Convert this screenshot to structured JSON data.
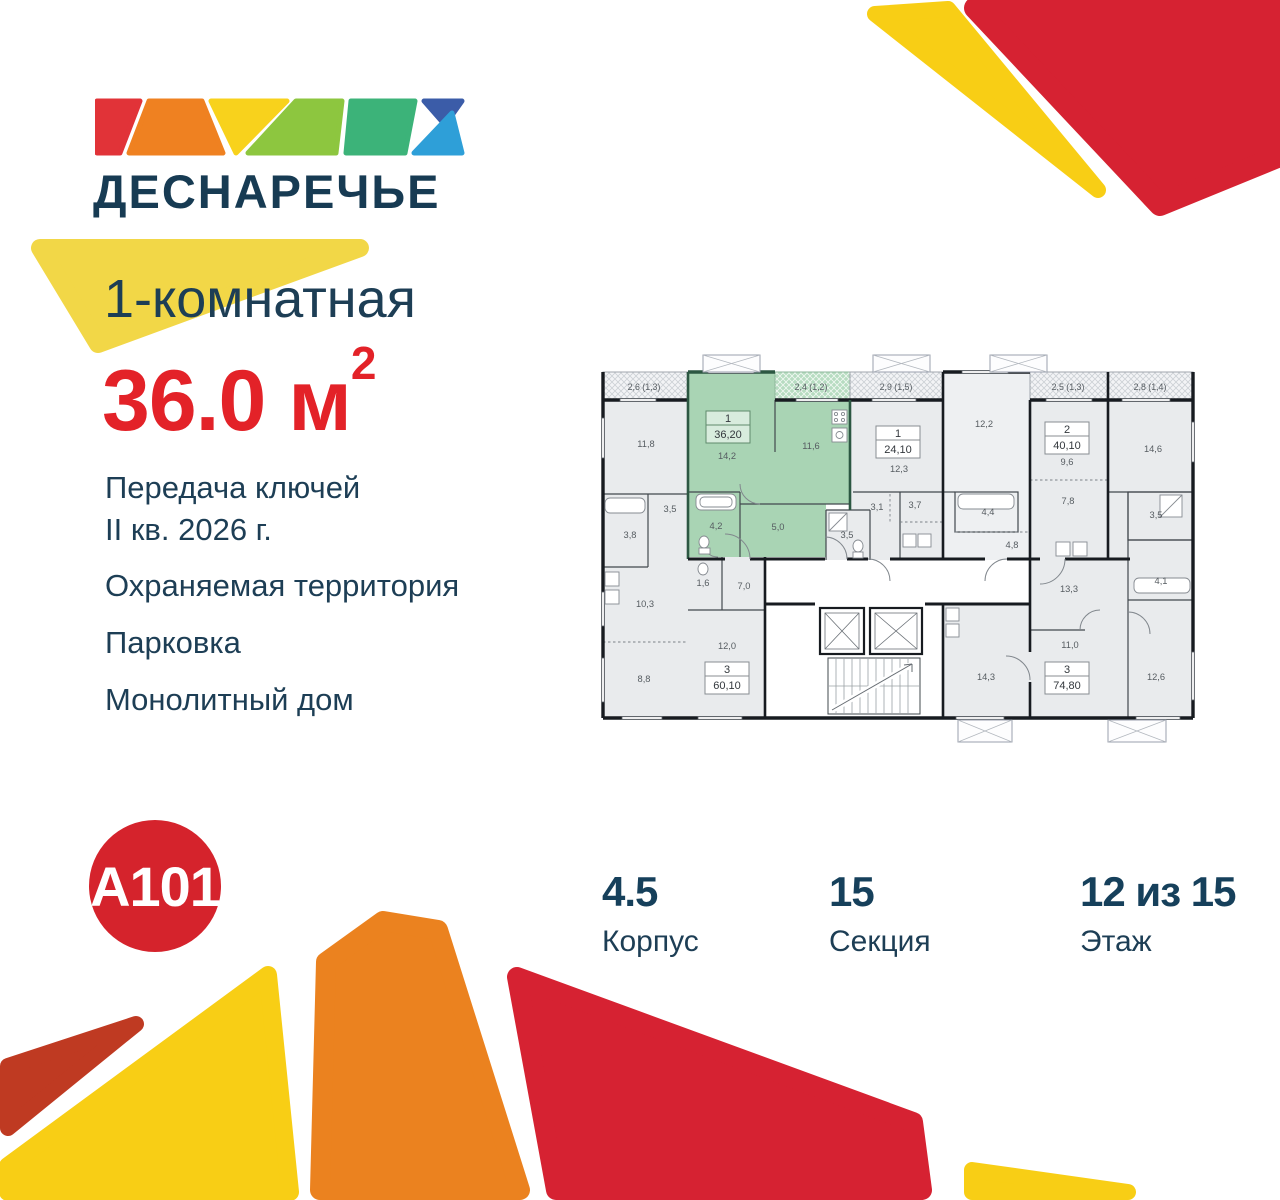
{
  "brand": {
    "logo_text": "ДЕСНАРЕЧЬЕ",
    "developer_logo": "A101"
  },
  "listing": {
    "title": "1-комнатная",
    "area_value": "36.0",
    "area_unit": " м",
    "area_superscript": "2",
    "features": {
      "handover_line1": "Передача ключей",
      "handover_line2": "II кв. 2026 г.",
      "security": "Охраняемая территория",
      "parking": "Парковка",
      "construction": "Монолитный дом"
    }
  },
  "stats": {
    "building_value": "4.5",
    "building_label": "Корпус",
    "section_value": "15",
    "section_label": "Секция",
    "floor_value": "12 из 15",
    "floor_label": "Этаж"
  },
  "colors": {
    "navy": "#1d3e55",
    "accent_red": "#e32228",
    "a101_red": "#d5232c",
    "deco_yellow": "#f8ce15",
    "deco_orange": "#eb821f",
    "deco_red": "#d62232",
    "deco_dark_red": "#bf3a22",
    "plan_highlight_green": "#a9d4b4",
    "plan_room_gray": "#e9ebed"
  },
  "floor_plan": {
    "highlighted_unit": {
      "number": "1",
      "area": "36,20"
    },
    "unit_labels": [
      {
        "x": 128,
        "y": 75,
        "number": "1",
        "area": "36,20",
        "hl": true
      },
      {
        "x": 298,
        "y": 90,
        "number": "1",
        "area": "24,10",
        "hl": false
      },
      {
        "x": 467,
        "y": 86,
        "number": "2",
        "area": "40,10",
        "hl": false
      },
      {
        "x": 127,
        "y": 326,
        "number": "3",
        "area": "60,10",
        "hl": false
      },
      {
        "x": 467,
        "y": 326,
        "number": "3",
        "area": "74,80",
        "hl": false
      }
    ],
    "balcony_labels": [
      {
        "x": 44,
        "y": 38,
        "t": "2,6 (1,3)"
      },
      {
        "x": 211,
        "y": 38,
        "t": "2,4 (1,2)"
      },
      {
        "x": 296,
        "y": 38,
        "t": "2,9 (1,5)"
      },
      {
        "x": 468,
        "y": 38,
        "t": "2,5 (1,3)"
      },
      {
        "x": 550,
        "y": 38,
        "t": "2,8 (1,4)"
      }
    ],
    "room_labels": [
      {
        "x": 46,
        "y": 95,
        "t": "11,8"
      },
      {
        "x": 127,
        "y": 107,
        "t": "14,2"
      },
      {
        "x": 211,
        "y": 97,
        "t": "11,6"
      },
      {
        "x": 299,
        "y": 120,
        "t": "12,3"
      },
      {
        "x": 384,
        "y": 75,
        "t": "12,2"
      },
      {
        "x": 467,
        "y": 113,
        "t": "9,6"
      },
      {
        "x": 553,
        "y": 100,
        "t": "14,6"
      },
      {
        "x": 70,
        "y": 160,
        "t": "3,5"
      },
      {
        "x": 30,
        "y": 186,
        "t": "3,8"
      },
      {
        "x": 116,
        "y": 177,
        "t": "4,2"
      },
      {
        "x": 178,
        "y": 178,
        "t": "5,0"
      },
      {
        "x": 247,
        "y": 186,
        "t": "3,5"
      },
      {
        "x": 277,
        "y": 158,
        "t": "3,1"
      },
      {
        "x": 315,
        "y": 156,
        "t": "3,7"
      },
      {
        "x": 388,
        "y": 163,
        "t": "4,4"
      },
      {
        "x": 412,
        "y": 196,
        "t": "4,8"
      },
      {
        "x": 468,
        "y": 152,
        "t": "7,8"
      },
      {
        "x": 556,
        "y": 166,
        "t": "3,5"
      },
      {
        "x": 561,
        "y": 232,
        "t": "4,1"
      },
      {
        "x": 103,
        "y": 234,
        "t": "1,6"
      },
      {
        "x": 144,
        "y": 237,
        "t": "7,0"
      },
      {
        "x": 45,
        "y": 255,
        "t": "10,3"
      },
      {
        "x": 469,
        "y": 240,
        "t": "13,3"
      },
      {
        "x": 127,
        "y": 297,
        "t": "12,0"
      },
      {
        "x": 44,
        "y": 330,
        "t": "8,8"
      },
      {
        "x": 470,
        "y": 296,
        "t": "11,0"
      },
      {
        "x": 386,
        "y": 328,
        "t": "14,3"
      },
      {
        "x": 556,
        "y": 328,
        "t": "12,6"
      }
    ]
  }
}
